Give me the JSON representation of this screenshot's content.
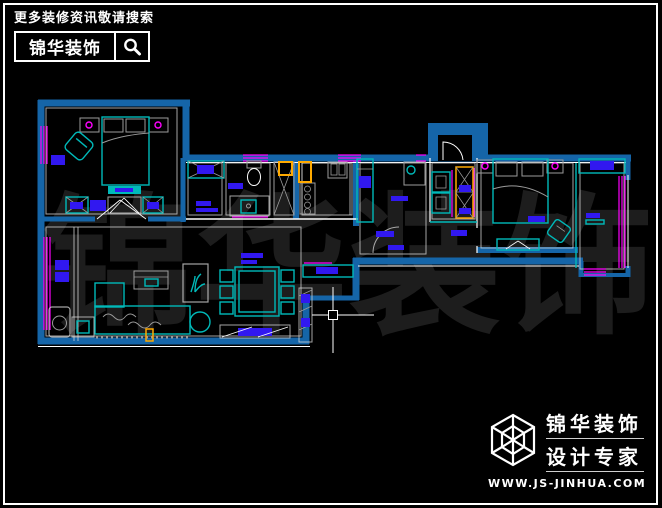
{
  "canvas": {
    "width": 662,
    "height": 508,
    "background": "#000000",
    "frame_color": "#ffffff"
  },
  "palette": {
    "wall": "#1565a8",
    "furniture": "#00b9b9",
    "fill": "#3118f0",
    "window": "#ff00ff",
    "accent": "#ffaa00",
    "line": "#ffffff",
    "detail": "#9b9b9b",
    "watermark": "#1d1d1d"
  },
  "header": {
    "tagline": "更多装修资讯敬请搜索",
    "brand": "锦华装饰",
    "search_icon": "magnifier"
  },
  "watermark": {
    "text": "锦华装饰",
    "chars": [
      "锦",
      "华",
      "装",
      "饰"
    ]
  },
  "footer": {
    "logo_icon": "wireframe-cube",
    "brand_line1": "锦华装饰",
    "brand_line2": "设计专家",
    "website": "WWW.JS-JINHUA.COM"
  },
  "cursor": {
    "type": "cad-crosshair",
    "x": 333,
    "y": 315
  }
}
